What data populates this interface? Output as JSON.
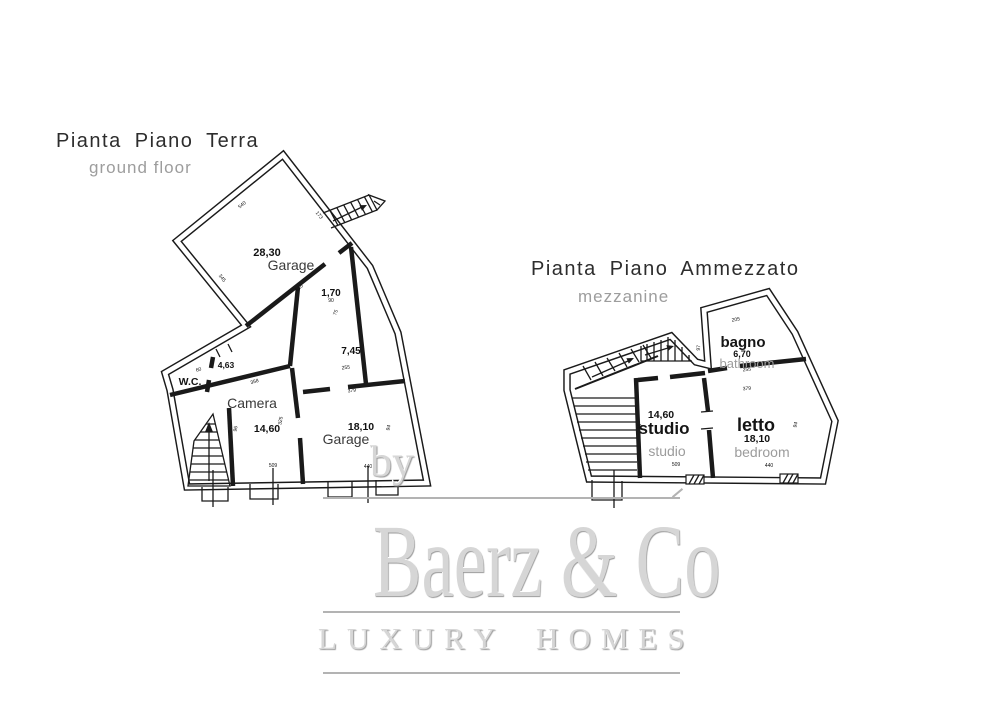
{
  "ground_plan": {
    "title": "Pianta Piano Terra",
    "subtitle": "ground floor",
    "rooms": {
      "garage_top": {
        "name": "Garage",
        "area": "28,30"
      },
      "nook": {
        "area": "1,70"
      },
      "corridor": {
        "area": "7,45"
      },
      "anteroom": {
        "area": "4,63"
      },
      "wc": {
        "name": "W.C."
      },
      "camera": {
        "name": "Camera",
        "area": "14,60"
      },
      "garage_right": {
        "name": "Garage",
        "area": "18,10"
      }
    },
    "dims": [
      {
        "t": "540",
        "x": 243,
        "y": 206,
        "r": -39
      },
      {
        "t": "173",
        "x": 318,
        "y": 216,
        "r": 52
      },
      {
        "t": "345",
        "x": 221,
        "y": 279,
        "r": 51
      },
      {
        "t": "610",
        "x": 300,
        "y": 289,
        "r": -38
      },
      {
        "t": "90",
        "x": 331,
        "y": 302,
        "r": 0
      },
      {
        "t": "75",
        "x": 337,
        "y": 313,
        "r": -70
      },
      {
        "t": "255",
        "x": 346,
        "y": 369,
        "r": -7
      },
      {
        "t": "379",
        "x": 352,
        "y": 392,
        "r": -7
      },
      {
        "t": "358",
        "x": 255,
        "y": 383,
        "r": -17
      },
      {
        "t": "60",
        "x": 199,
        "y": 371,
        "r": -17
      },
      {
        "t": "96",
        "x": 237,
        "y": 429,
        "r": -80
      },
      {
        "t": "325",
        "x": 282,
        "y": 421,
        "r": -80
      },
      {
        "t": "94",
        "x": 390,
        "y": 428,
        "r": -78
      },
      {
        "t": "509",
        "x": 273,
        "y": 467,
        "r": 0
      },
      {
        "t": "440",
        "x": 368,
        "y": 468,
        "r": 0
      }
    ]
  },
  "mezzanine_plan": {
    "title": "Pianta Piano Ammezzato",
    "subtitle": "mezzanine",
    "rooms": {
      "bagno": {
        "name": "bagno",
        "area": "6,70",
        "translation": "bathroom"
      },
      "studio": {
        "name": "studio",
        "area": "14,60",
        "translation": "studio"
      },
      "letto": {
        "name": "letto",
        "area": "18,10",
        "translation": "bedroom"
      }
    },
    "dims": [
      {
        "t": "205",
        "x": 736,
        "y": 321,
        "r": -8
      },
      {
        "t": "97",
        "x": 700,
        "y": 348,
        "r": -85
      },
      {
        "t": "255",
        "x": 747,
        "y": 371,
        "r": -5
      },
      {
        "t": "379",
        "x": 747,
        "y": 390,
        "r": -5
      },
      {
        "t": "358",
        "x": 654,
        "y": 380,
        "r": -9
      },
      {
        "t": "95",
        "x": 641,
        "y": 427,
        "r": -82
      },
      {
        "t": "94",
        "x": 797,
        "y": 425,
        "r": -78
      },
      {
        "t": "509",
        "x": 676,
        "y": 466,
        "r": 0
      },
      {
        "t": "440",
        "x": 769,
        "y": 467,
        "r": 0
      }
    ]
  },
  "watermark": {
    "prefix": "by",
    "brand": "Baerz & Co",
    "tagline": "LUXURY HOMES"
  },
  "colors": {
    "line": "#1a1a1a",
    "muted_text": "#9d9d9d",
    "watermark": "#d6d6d6",
    "watermark_line": "#b3b3b3"
  }
}
